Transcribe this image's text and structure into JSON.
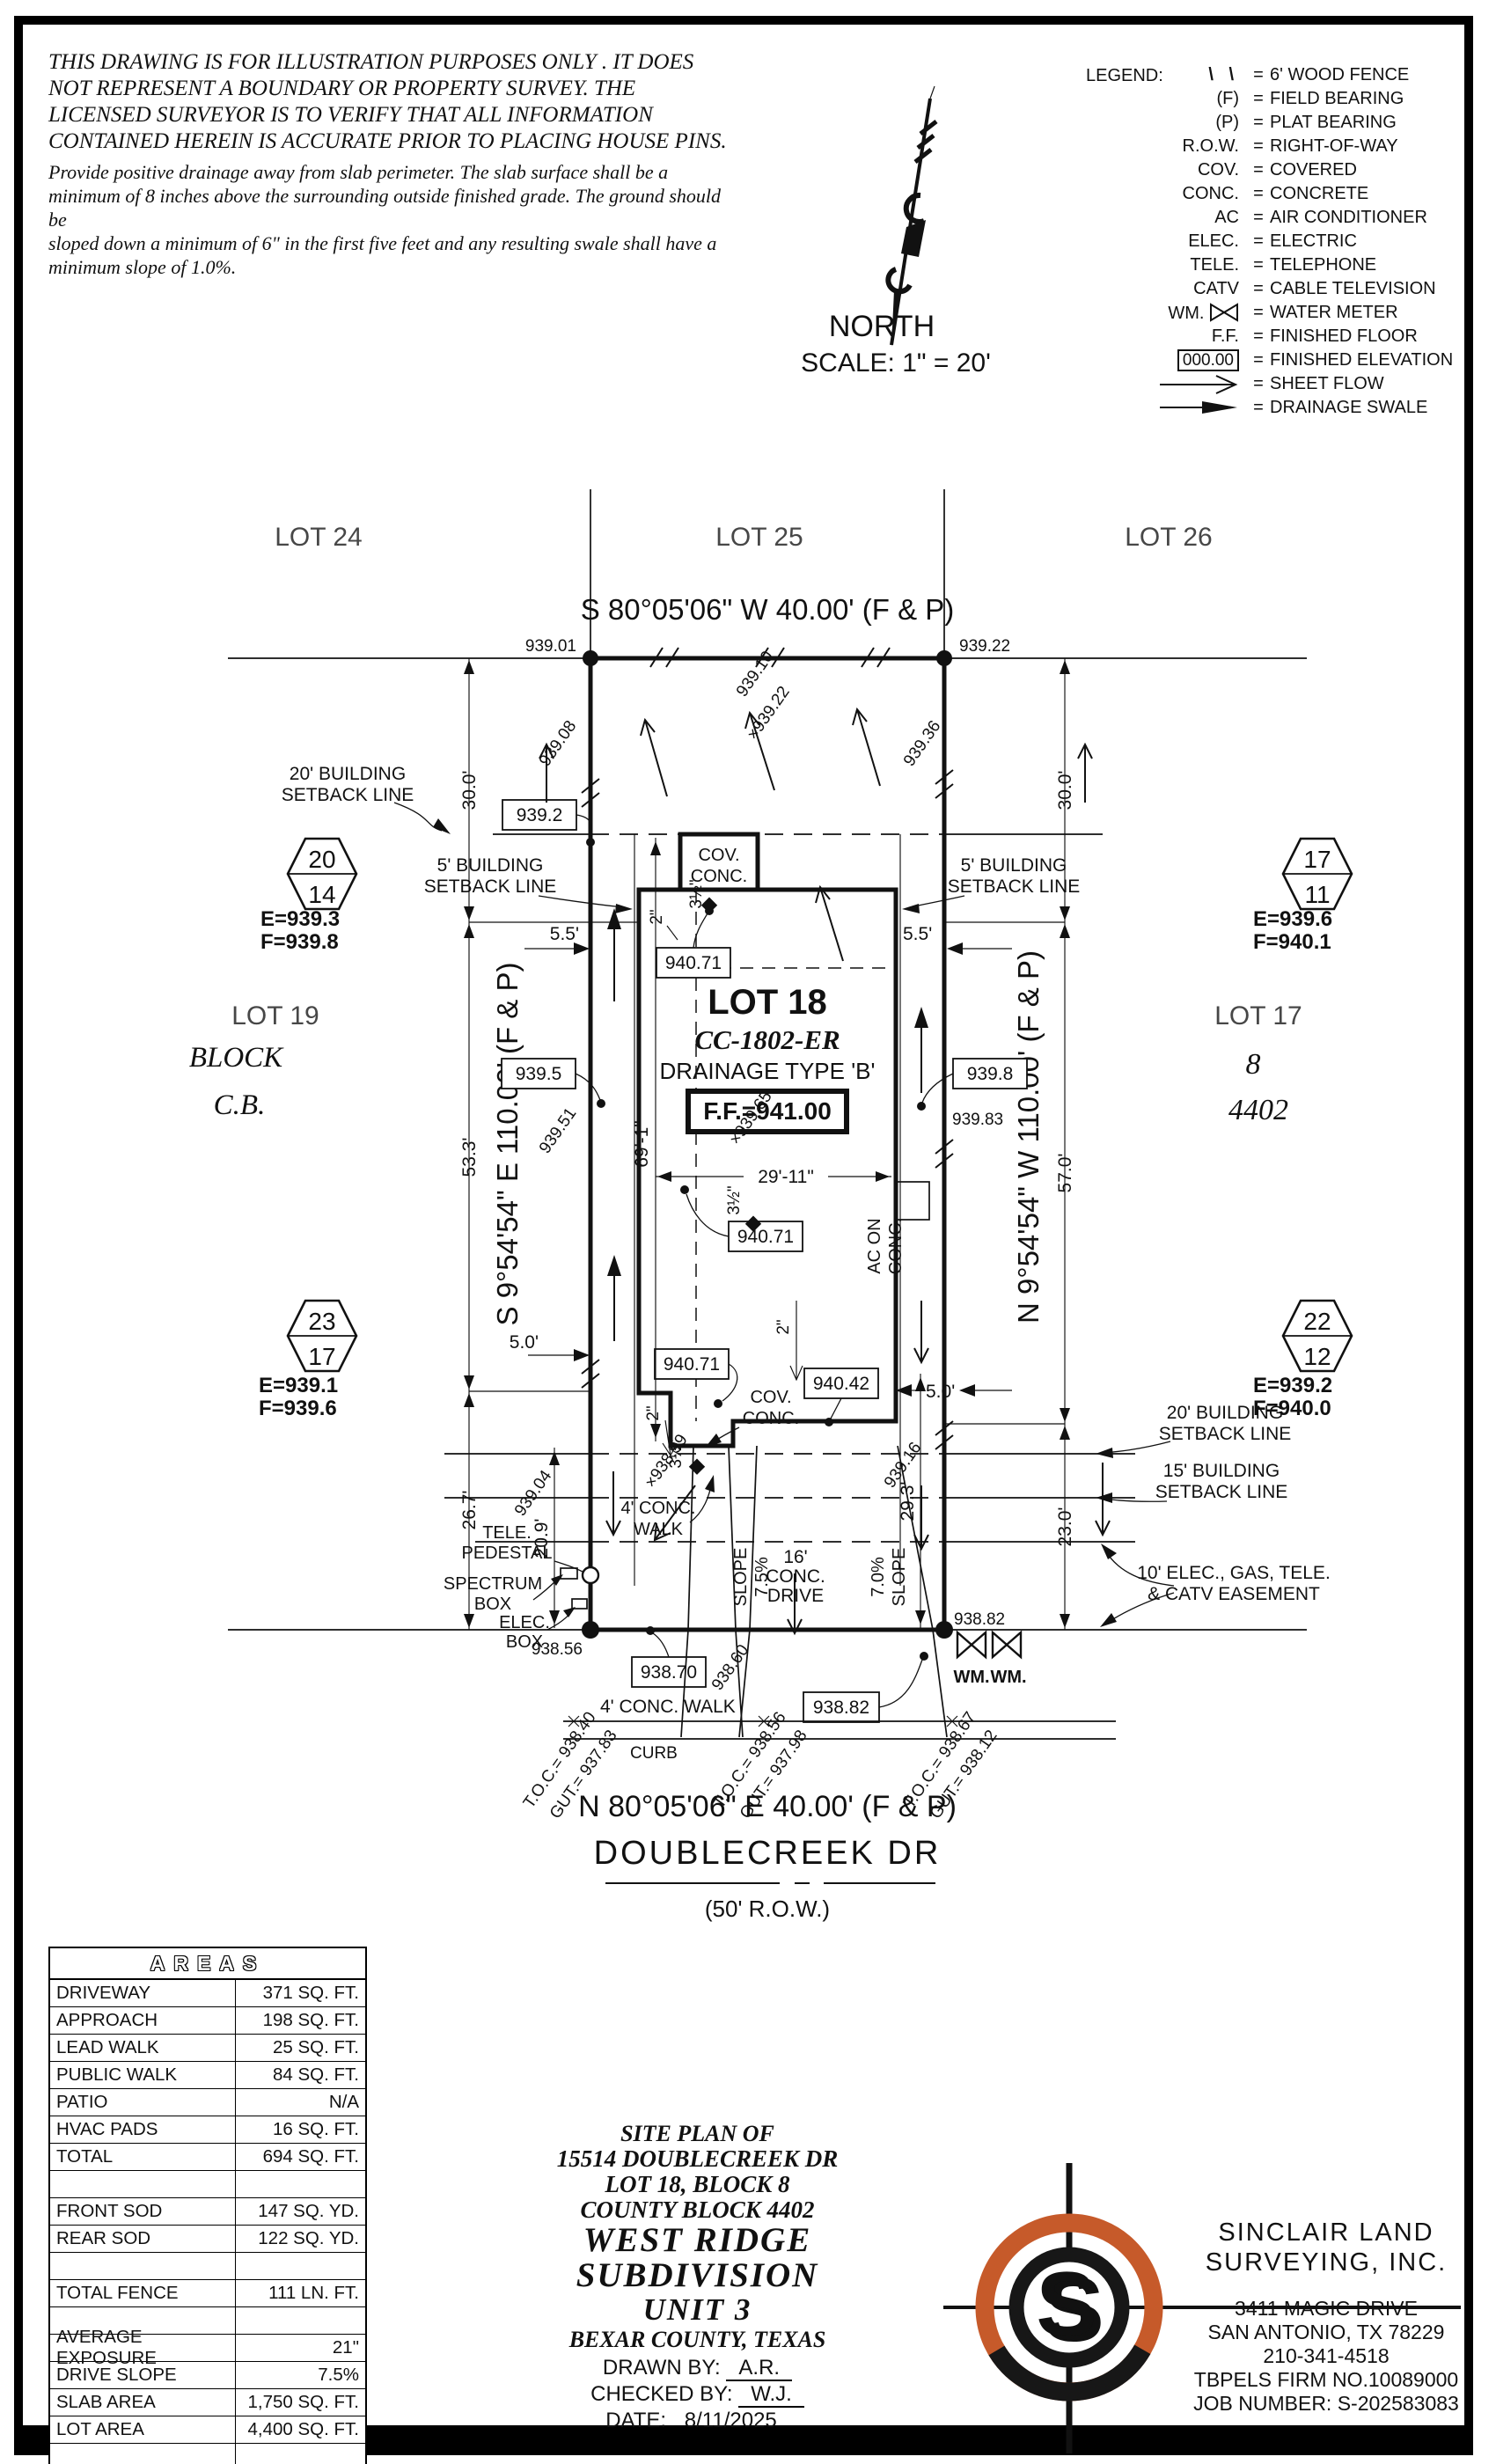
{
  "disclaimer": {
    "p1": [
      "THIS DRAWING IS FOR ILLUSTRATION PURPOSES ONLY . IT DOES",
      "NOT REPRESENT A BOUNDARY OR PROPERTY SURVEY. THE",
      "LICENSED SURVEYOR IS TO VERIFY THAT ALL INFORMATION",
      "CONTAINED HEREIN IS ACCURATE PRIOR TO PLACING HOUSE PINS."
    ],
    "p2": [
      "Provide positive drainage away from slab perimeter. The slab surface shall be a",
      "minimum of 8 inches above the surrounding outside finished grade. The ground should be",
      "sloped down a minimum of 6\" in the first five feet and any resulting swale shall have a",
      "minimum slope of 1.0%."
    ]
  },
  "north": {
    "label": "NORTH",
    "scale": "SCALE: 1\" = 20'"
  },
  "legend": {
    "title": "LEGEND:",
    "eq": "=",
    "items": [
      {
        "sym": "\\ \\",
        "label": "6' WOOD FENCE"
      },
      {
        "sym": "(F)",
        "label": "FIELD BEARING"
      },
      {
        "sym": "(P)",
        "label": "PLAT BEARING"
      },
      {
        "sym": "R.O.W.",
        "label": "RIGHT-OF-WAY"
      },
      {
        "sym": "COV.",
        "label": "COVERED"
      },
      {
        "sym": "CONC.",
        "label": "CONCRETE"
      },
      {
        "sym": "AC",
        "label": "AIR CONDITIONER"
      },
      {
        "sym": "ELEC.",
        "label": "ELECTRIC"
      },
      {
        "sym": "TELE.",
        "label": "TELEPHONE"
      },
      {
        "sym": "CATV",
        "label": "CABLE TELEVISION"
      },
      {
        "sym": "WM.",
        "label": "WATER METER"
      },
      {
        "sym": "F.F.",
        "label": "FINISHED FLOOR"
      },
      {
        "sym": "000.00",
        "label": "FINISHED ELEVATION"
      },
      {
        "sym": "",
        "label": "SHEET FLOW"
      },
      {
        "sym": "",
        "label": "DRAINAGE SWALE"
      }
    ]
  },
  "plan": {
    "lots_top": [
      "LOT 24",
      "LOT 25",
      "LOT 26"
    ],
    "bearing_top": "S 80°05'06\" W 40.00' (F & P)",
    "bearing_bottom": "N 80°05'06\" E 40.00' (F & P)",
    "bearing_left": "S 9°54'54\" E 110.00' (F & P)",
    "bearing_right": "N 9°54'54\" W 110.00' (F & P)",
    "street_name": "DOUBLECREEK DR",
    "street_row": "(50' R.O.W.)",
    "lot18": {
      "title": "LOT 18",
      "code": "CC-1802-ER",
      "drainage": "DRAINAGE TYPE 'B'",
      "ff": "F.F.=941.00"
    },
    "adj_left": {
      "lot": "LOT 19",
      "block_word": "BLOCK",
      "block": "C.B."
    },
    "adj_right": {
      "lot": "LOT 17",
      "block": "8",
      "cb": "4402"
    },
    "markers": [
      {
        "top": "20",
        "bottom": "14",
        "e": "E=939.3",
        "f": "F=939.8"
      },
      {
        "top": "17",
        "bottom": "11",
        "e": "E=939.6",
        "f": "F=940.1"
      },
      {
        "top": "23",
        "bottom": "17",
        "e": "E=939.1",
        "f": "F=939.6"
      },
      {
        "top": "22",
        "bottom": "12",
        "e": "E=939.2",
        "f": "F=940.0"
      }
    ],
    "labels": {
      "setback20_left_1": "20' BUILDING",
      "setback20_left_2": "SETBACK LINE",
      "setback5_left_1": "5' BUILDING",
      "setback5_left_2": "SETBACK LINE",
      "setback5_right_1": "5' BUILDING",
      "setback5_right_2": "SETBACK LINE",
      "setback20_right_1": "20' BUILDING",
      "setback20_right_2": "SETBACK LINE",
      "setback15_right_1": "15' BUILDING",
      "setback15_right_2": "SETBACK LINE",
      "easement_1": "10' ELEC., GAS, TELE.",
      "easement_2": "& CATV EASEMENT",
      "cov_conc_1": "COV.",
      "cov_conc_2": "CONC.",
      "cov_conc_front_1": "COV.",
      "cov_conc_front_2": "CONC.",
      "ac_1": "AC ON",
      "ac_2": "CONC.",
      "tele_1": "TELE.",
      "tele_2": "PEDESTAL",
      "spectrum_1": "SPECTRUM",
      "spectrum_2": "BOX",
      "elec_1": "ELEC.",
      "elec_2": "BOX",
      "walk_front_1": "4' CONC.",
      "walk_front_2": "WALK",
      "walk_public": "4' CONC. WALK",
      "curb": "CURB",
      "drive_1": "16'",
      "drive_2": "CONC.",
      "drive_3": "DRIVE",
      "slope_left_a": "SLOPE",
      "slope_left_b": "7.5%",
      "slope_right_a": "7.0%",
      "slope_right_b": "SLOPE",
      "wm1": "WM.",
      "wm2": "WM."
    },
    "dims": {
      "d30l": "30.0'",
      "d53": "53.3'",
      "d26": "26.7'",
      "d30r": "30.0'",
      "d57": "57.0'",
      "d23": "23.0'",
      "d55l": "5.5'",
      "d55r": "5.5'",
      "d50l": "5.0'",
      "d50r": "5.0'",
      "d691": "69'-1\"",
      "d2911": "29'-11\"",
      "d209": "20.9'",
      "d293": "29.3'",
      "d2a": "2\"",
      "d2b": "2\"",
      "d2c": "2\"",
      "d35a": "3½\"",
      "d35b": "3½\"",
      "d35c": "3½\""
    },
    "spots": {
      "s93901": "939.01",
      "s93922": "939.22",
      "s93908": "939.08",
      "s93910": "939.10",
      "sx93922": "×939.22",
      "s93936": "939.36",
      "s93951": "939.51",
      "sx93965": "×939.65",
      "s93983": "939.83",
      "s93904": "939.04",
      "sx93899": "×938.99",
      "s93916": "939.16",
      "s93856": "938.56",
      "s93860": "938.60",
      "s93882": "938.82"
    },
    "boxed": {
      "b9392": "939.2",
      "b94071a": "940.71",
      "b9395": "939.5",
      "b9398": "939.8",
      "b94071b": "940.71",
      "b94071c": "940.71",
      "b94042": "940.42",
      "b93870": "938.70",
      "b93882": "938.82"
    },
    "toc": [
      {
        "a": "T.O.C.= 938.40",
        "b": "GUT.= 937.83"
      },
      {
        "a": "T.O.C.= 938.56",
        "b": "GUT.= 937.98"
      },
      {
        "a": "T.O.C.= 938.67",
        "b": "GUT.= 938.12"
      }
    ]
  },
  "areas": {
    "title": "AREAS",
    "rows": [
      {
        "label": "DRIVEWAY",
        "value": "371 SQ. FT."
      },
      {
        "label": "APPROACH",
        "value": "198 SQ. FT."
      },
      {
        "label": "LEAD WALK",
        "value": "25 SQ. FT."
      },
      {
        "label": "PUBLIC WALK",
        "value": "84 SQ. FT."
      },
      {
        "label": "PATIO",
        "value": "N/A"
      },
      {
        "label": "HVAC PADS",
        "value": "16 SQ. FT."
      },
      {
        "label": "TOTAL",
        "value": "694 SQ. FT."
      },
      {
        "label": "",
        "value": ""
      },
      {
        "label": "FRONT SOD",
        "value": "147 SQ. YD."
      },
      {
        "label": "REAR SOD",
        "value": "122 SQ. YD."
      },
      {
        "label": "",
        "value": ""
      },
      {
        "label": "TOTAL FENCE",
        "value": "111 LN. FT."
      },
      {
        "label": "",
        "value": ""
      },
      {
        "label": "AVERAGE EXPOSURE",
        "value": "21\""
      },
      {
        "label": "DRIVE SLOPE",
        "value": "7.5%"
      },
      {
        "label": "SLAB AREA",
        "value": "1,750 SQ. FT."
      },
      {
        "label": "LOT AREA",
        "value": "4,400 SQ. FT."
      },
      {
        "label": "",
        "value": ""
      }
    ]
  },
  "title_block": {
    "l1": "SITE PLAN OF",
    "l2": "15514 DOUBLECREEK DR",
    "l3": "LOT 18, BLOCK 8",
    "l4": "COUNTY BLOCK 4402",
    "l5": "WEST RIDGE SUBDIVISION",
    "l6": "UNIT 3",
    "l7": "BEXAR COUNTY, TEXAS",
    "drawn_label": "DRAWN BY:",
    "drawn": "A.R.",
    "checked_label": "CHECKED BY:",
    "checked": "W.J.",
    "date_label": "DATE:",
    "date": "8/11/2025"
  },
  "company": {
    "name1": "SINCLAIR LAND",
    "name2": "SURVEYING, INC.",
    "addr1": "3411 MAGIC DRIVE",
    "addr2": "SAN ANTONIO, TX 78229",
    "phone": "210-341-4518",
    "firm": "TBPELS FIRM NO.10089000",
    "job": "JOB NUMBER: S-202583083",
    "logo_letter": "S"
  },
  "colors": {
    "brand_orange": "#c65a2a",
    "ink": "#111111"
  }
}
